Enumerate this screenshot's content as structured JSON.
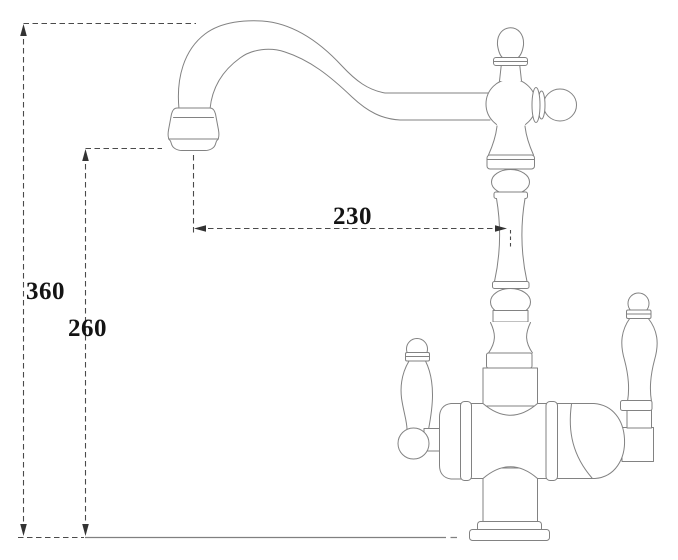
{
  "page": {
    "background": "#ffffff"
  },
  "drawing": {
    "subject": "Two-handle kitchen faucet - dimensioned technical line drawing",
    "outline_color": "#828282",
    "dimension_line_color": "#4a4a4a",
    "baseline_color": "#808080",
    "arrow_color": "#333333",
    "label_color": "#141414",
    "labels": {
      "overall_height": "360",
      "spout_height": "260",
      "spout_reach": "230"
    }
  }
}
